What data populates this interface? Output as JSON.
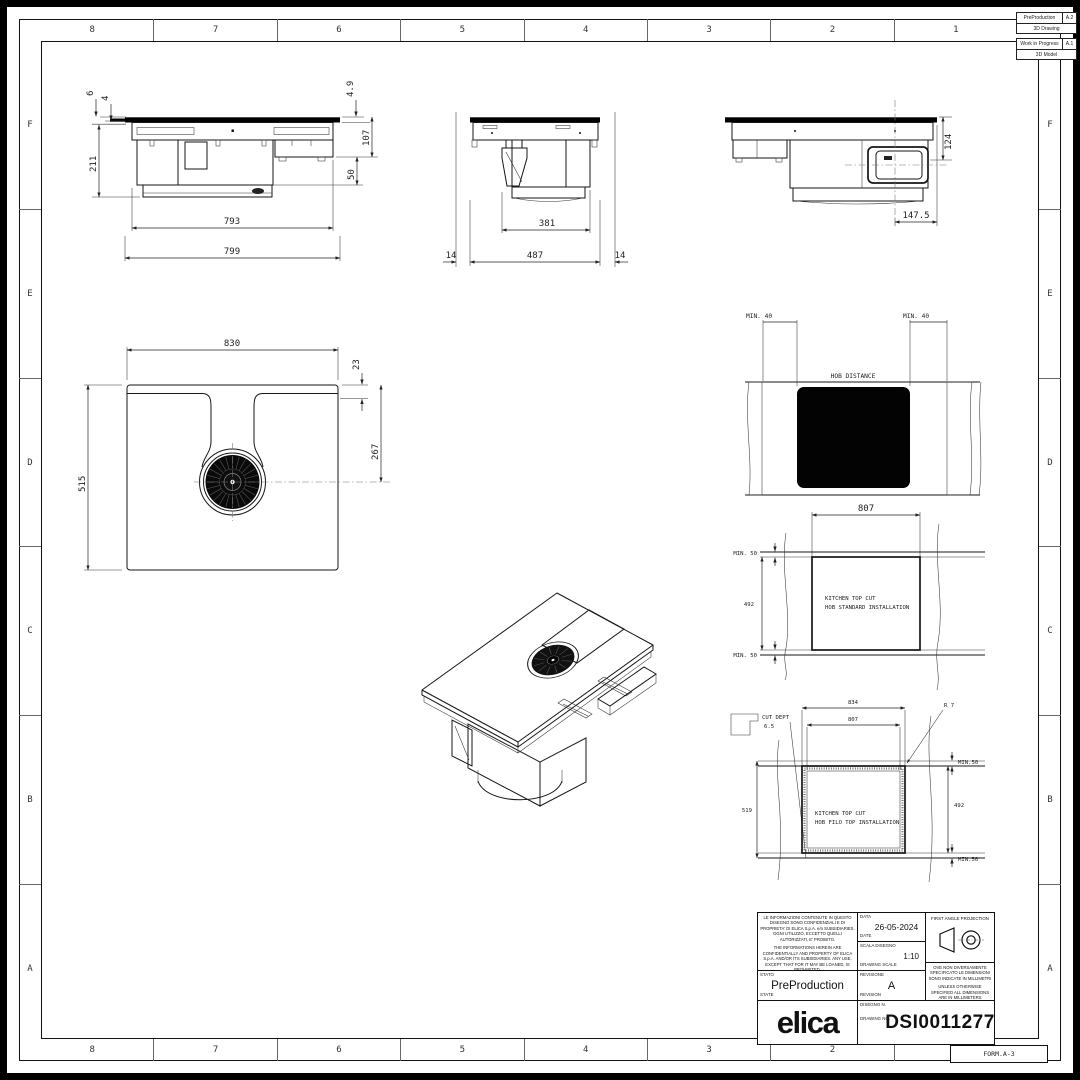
{
  "sheet": {
    "form_label": "FORM.A-3",
    "zone_columns": [
      "8",
      "7",
      "6",
      "5",
      "4",
      "3",
      "2",
      "1"
    ],
    "zone_rows": [
      "F",
      "E",
      "D",
      "C",
      "B",
      "A"
    ]
  },
  "status_boxes": [
    {
      "state": "PreProduction",
      "rev": "A.2",
      "type": "3D Drawing"
    },
    {
      "state": "Work in Progress",
      "rev": "A.1",
      "type": "3D Model"
    }
  ],
  "title_block": {
    "confidential_it": "LE INFORMAZIONI CONTENUTE IN QUESTO DISEGNO SONO CONFIDENZIALI E DI PROPRIETA' DI ELICA S.p.A. e/o SUBSIDIARIES. OGNI UTILIZZO, ECCETTO QUELLI AUTORIZZATI, E' PROIBITO.",
    "confidential_en": "THE INFORMATIONS HEREIN ARE CONFIDENTIALLY AND PROPERTY OF ELICA S.p.A. AND/OR ITS SUBSIDIARIES. ANY USE, EXCEPT THAT FOR IT MAY BE LOANED, IS PROHIBITED.",
    "date_label_it": "DATA",
    "date_label_en": "DATE",
    "date_value": "26-05-2024",
    "scale_label_it": "SCALA DISEGNO",
    "scale_label_en": "DRAWING SCALE",
    "scale_value": "1:10",
    "projection_label": "FIRST ANGLE PROJECTION",
    "units_note_it": "OVE NON DIVERSAMENTE SPECIFICATO LE DIMENSIONI SONO INDICATE IN MILLIMETRI",
    "units_note_en": "UNLESS OTHERWISE SPECIFIED ALL DIMENSIONS ARE IN MILLIMETERS",
    "state_label_it": "STATO",
    "state_label_en": "STATE",
    "state_value": "PreProduction",
    "revision_label_it": "REVISIONE",
    "revision_label_en": "REVISION",
    "revision_value": "A",
    "drawing_no_label_it": "DISEGNO N.",
    "drawing_no_label_en": "DRAWING NO.",
    "drawing_no_value": "DSI0011277",
    "brand": "elica"
  },
  "views": {
    "front": {
      "d6": "6",
      "d4": "4",
      "d211": "211",
      "d793": "793",
      "d799": "799",
      "d49": "4.9",
      "d107": "107",
      "d50": "50"
    },
    "side": {
      "d381": "381",
      "d487": "487",
      "d14l": "14",
      "d14r": "14"
    },
    "side2": {
      "d124": "124",
      "d1475": "147.5"
    },
    "plan": {
      "d830": "830",
      "d23": "23",
      "d267": "267",
      "d515": "515"
    },
    "hob_distance": {
      "label": "HOB DISTANCE",
      "min_left": "MIN. 40",
      "min_right": "MIN. 40"
    },
    "standard_cut": {
      "line1": "KITCHEN TOP CUT",
      "line2": "HOB STANDARD INSTALLATION",
      "d807": "807",
      "d492": "492",
      "min_top": "MIN. 50",
      "min_bottom": "MIN. 50"
    },
    "filo_cut": {
      "line1": "KITCHEN TOP CUT",
      "line2": "HOB FILO TOP INSTALLATION",
      "cut_dept_label": "CUT DEPT",
      "cut_dept_value": "6.5",
      "d834": "834",
      "d807": "807",
      "r7": "R 7",
      "d519": "519",
      "d492": "492",
      "min_top": "MIN.50",
      "min_bottom": "MIN.50"
    }
  }
}
